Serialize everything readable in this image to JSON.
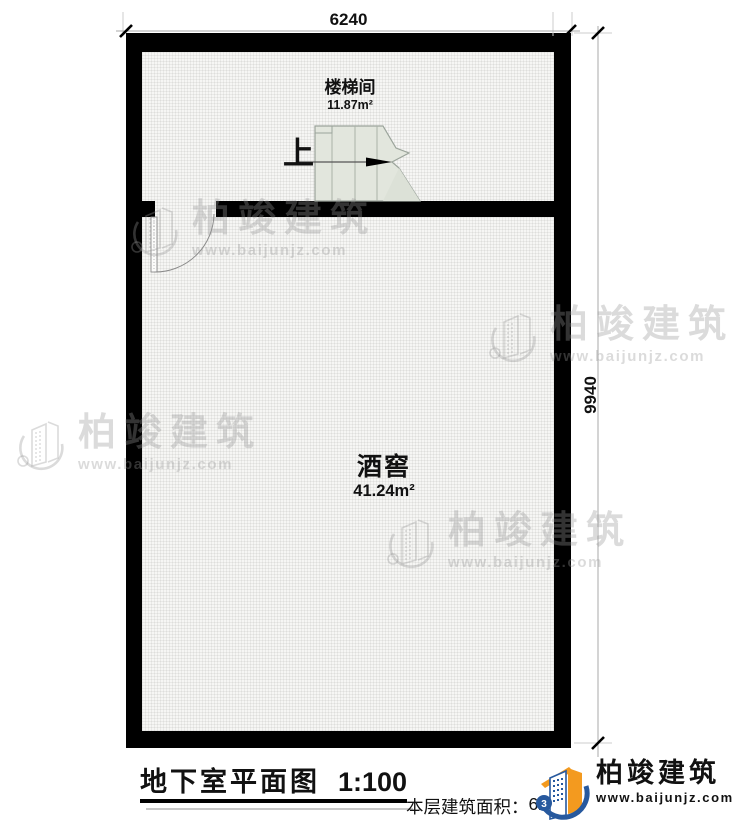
{
  "dimensions": {
    "top": "6240",
    "right": "9940"
  },
  "rooms": [
    {
      "name": "楼梯间",
      "area": "11.87m²"
    },
    {
      "name": "酒窖",
      "area": "41.24m²"
    }
  ],
  "stairs": {
    "direction_label": "上"
  },
  "title": {
    "text": "地下室平面图",
    "scale": "1:100"
  },
  "footer": {
    "area_label": "本层建筑面积：",
    "area_value": "62."
  },
  "logo": {
    "company": "柏竣建筑",
    "website": "www.baijunjz.com",
    "badge_glyph": "3"
  },
  "watermark": {
    "company": "柏竣建筑",
    "website": "www.baijunjz.com"
  },
  "palette": {
    "wall": "#000000",
    "stair_fill": "#e2e6dd",
    "logo_blue": "#27599e",
    "logo_orange": "#f39a1f",
    "logo_text": "#221d1a"
  }
}
